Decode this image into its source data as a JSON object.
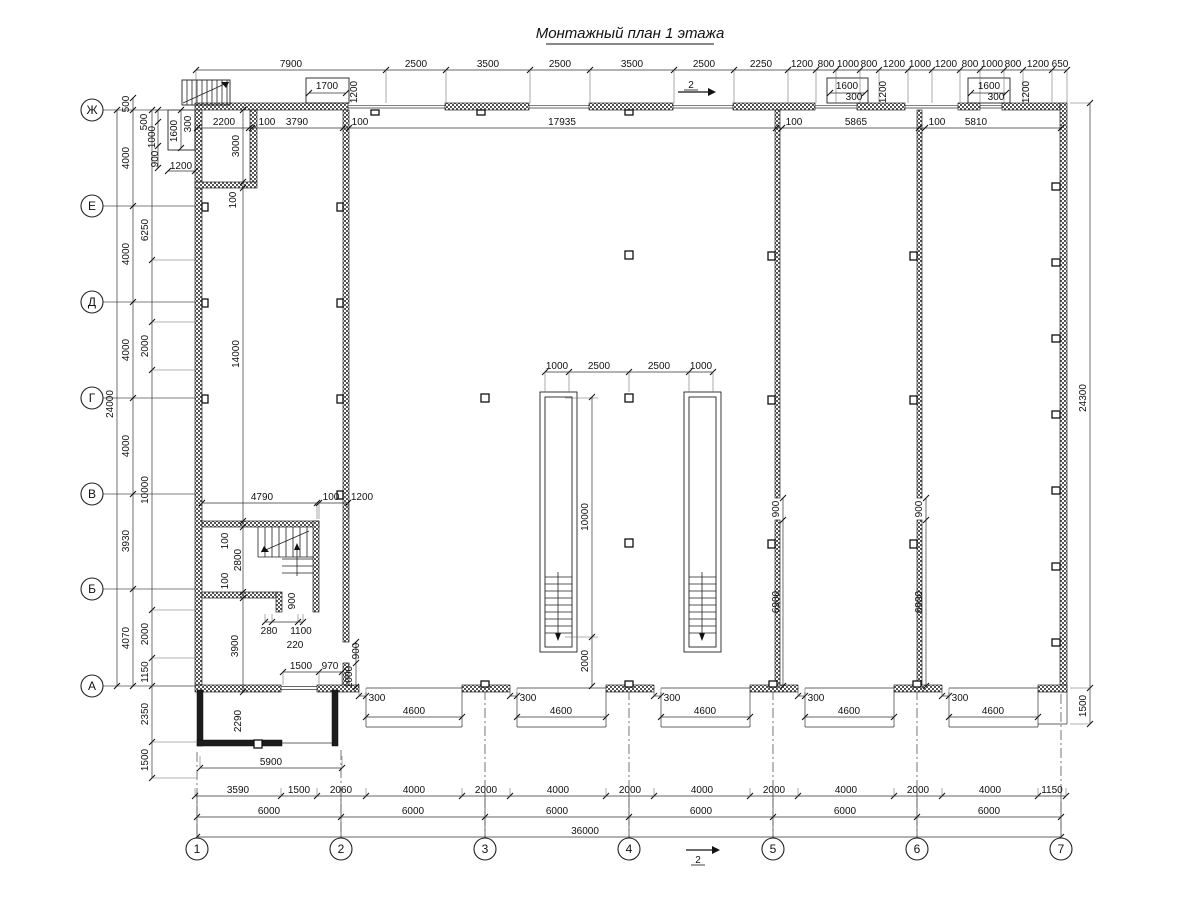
{
  "title": "Монтажный план 1 этажа",
  "axis_labels_left": [
    {
      "label": "Ж",
      "y": 110
    },
    {
      "label": "Е",
      "y": 206
    },
    {
      "label": "Д",
      "y": 302
    },
    {
      "label": "Г",
      "y": 398
    },
    {
      "label": "В",
      "y": 494
    },
    {
      "label": "Б",
      "y": 589
    },
    {
      "label": "А",
      "y": 686
    }
  ],
  "axis_labels_bottom": [
    {
      "label": "1",
      "x": 197
    },
    {
      "label": "2",
      "x": 341
    },
    {
      "label": "3",
      "x": 485
    },
    {
      "label": "4",
      "x": 629
    },
    {
      "label": "5",
      "x": 773
    },
    {
      "label": "6",
      "x": 917
    },
    {
      "label": "7",
      "x": 1061
    }
  ],
  "section_marks": [
    {
      "label": "2",
      "x1": 678,
      "y1": 92,
      "x2": 708,
      "y2": 92,
      "lx": 691,
      "ly": 88
    },
    {
      "label": "2",
      "x1": 686,
      "y1": 850,
      "x2": 712,
      "y2": 850,
      "lx": 698,
      "ly": 863
    }
  ],
  "dim_chains": [
    {
      "o": "h",
      "c": 70,
      "e": 33,
      "t": [
        196,
        386,
        446,
        530,
        590,
        674,
        734,
        788,
        816,
        836,
        860,
        879,
        908,
        932,
        960,
        980,
        1004,
        1023,
        1052,
        1067
      ],
      "l": [
        {
          "v": "7900",
          "p": 291
        },
        {
          "v": "2500",
          "p": 416
        },
        {
          "v": "3500",
          "p": 488
        },
        {
          "v": "2500",
          "p": 560
        },
        {
          "v": "3500",
          "p": 632
        },
        {
          "v": "2500",
          "p": 704
        },
        {
          "v": "2250",
          "p": 761
        },
        {
          "v": "1200",
          "p": 802
        },
        {
          "v": "800",
          "p": 826
        },
        {
          "v": "1000",
          "p": 848
        },
        {
          "v": "800",
          "p": 869
        },
        {
          "v": "1200",
          "p": 894
        },
        {
          "v": "1000",
          "p": 920
        },
        {
          "v": "1200",
          "p": 946
        },
        {
          "v": "800",
          "p": 970
        },
        {
          "v": "1000",
          "p": 992
        },
        {
          "v": "800",
          "p": 1013
        },
        {
          "v": "1200",
          "p": 1038
        },
        {
          "v": "650",
          "p": 1060
        }
      ]
    },
    {
      "o": "h",
      "c": 128,
      "t": [
        197,
        249,
        252,
        343,
        349,
        776,
        782,
        919,
        925,
        1061
      ],
      "l": [
        {
          "v": "2200",
          "p": 224
        },
        {
          "v": "100",
          "p": 267
        },
        {
          "v": "3790",
          "p": 297
        },
        {
          "v": "100",
          "p": 360
        },
        {
          "v": "17935",
          "p": 562
        },
        {
          "v": "100",
          "p": 794
        },
        {
          "v": "5865",
          "p": 856
        },
        {
          "v": "100",
          "p": 937
        },
        {
          "v": "5810",
          "p": 976
        }
      ]
    },
    {
      "o": "h",
      "c": 372,
      "e": 20,
      "t": [
        545,
        569,
        629,
        689,
        713
      ],
      "l": [
        {
          "v": "1000",
          "p": 557
        },
        {
          "v": "2500",
          "p": 599
        },
        {
          "v": "2500",
          "p": 659
        },
        {
          "v": "1000",
          "p": 701
        }
      ]
    },
    {
      "o": "h",
      "c": 503,
      "e": 16,
      "t": [
        202,
        317,
        319,
        348
      ],
      "l": [
        {
          "v": "4790",
          "p": 262
        },
        {
          "v": "100",
          "p": 331
        },
        {
          "v": "1200",
          "p": 362
        }
      ]
    },
    {
      "o": "h",
      "c": 622,
      "e": -8,
      "t": [
        265,
        272,
        298,
        303
      ],
      "l": []
    },
    {
      "o": "h",
      "c": 672,
      "e": 13,
      "t": [
        283,
        319,
        342
      ],
      "l": [
        {
          "v": "1500",
          "p": 301
        },
        {
          "v": "970",
          "p": 330
        }
      ]
    },
    {
      "o": "h",
      "c": 717,
      "t": [
        366,
        462
      ],
      "l": [
        {
          "v": "4600",
          "p": 414
        }
      ]
    },
    {
      "o": "h",
      "c": 717,
      "t": [
        517,
        606
      ],
      "l": [
        {
          "v": "4600",
          "p": 561
        }
      ]
    },
    {
      "o": "h",
      "c": 717,
      "t": [
        661,
        750
      ],
      "l": [
        {
          "v": "4600",
          "p": 705
        }
      ]
    },
    {
      "o": "h",
      "c": 717,
      "t": [
        805,
        894
      ],
      "l": [
        {
          "v": "4600",
          "p": 849
        }
      ]
    },
    {
      "o": "h",
      "c": 717,
      "t": [
        949,
        1038
      ],
      "l": [
        {
          "v": "4600",
          "p": 993
        }
      ]
    },
    {
      "o": "h",
      "c": 696,
      "e": -8,
      "t": [
        359,
        366
      ],
      "l": []
    },
    {
      "o": "h",
      "c": 696,
      "e": -8,
      "t": [
        510,
        517
      ],
      "l": []
    },
    {
      "o": "h",
      "c": 696,
      "e": -8,
      "t": [
        654,
        661
      ],
      "l": []
    },
    {
      "o": "h",
      "c": 696,
      "e": -8,
      "t": [
        798,
        805
      ],
      "l": []
    },
    {
      "o": "h",
      "c": 696,
      "e": -8,
      "t": [
        942,
        949
      ],
      "l": []
    },
    {
      "o": "h",
      "c": 796,
      "e": -8,
      "t": [
        195,
        281,
        317,
        366,
        462,
        510,
        606,
        654,
        750,
        798,
        894,
        942,
        1038,
        1066
      ],
      "l": [
        {
          "v": "3590",
          "p": 238
        },
        {
          "v": "1500",
          "p": 299
        },
        {
          "v": "2060",
          "p": 341
        },
        {
          "v": "4000",
          "p": 414
        },
        {
          "v": "2000",
          "p": 486
        },
        {
          "v": "4000",
          "p": 558
        },
        {
          "v": "2000",
          "p": 630
        },
        {
          "v": "4000",
          "p": 702
        },
        {
          "v": "2000",
          "p": 774
        },
        {
          "v": "4000",
          "p": 846
        },
        {
          "v": "2000",
          "p": 918
        },
        {
          "v": "4000",
          "p": 990
        },
        {
          "v": "1150",
          "p": 1052
        }
      ]
    },
    {
      "o": "h",
      "c": 817,
      "e": -8,
      "t": [
        197,
        341,
        485,
        629,
        773,
        917,
        1061
      ],
      "l": [
        {
          "v": "6000",
          "p": 269
        },
        {
          "v": "6000",
          "p": 413
        },
        {
          "v": "6000",
          "p": 557
        },
        {
          "v": "6000",
          "p": 701
        },
        {
          "v": "6000",
          "p": 845
        },
        {
          "v": "6000",
          "p": 989
        }
      ]
    },
    {
      "o": "h",
      "c": 837,
      "e": -8,
      "t": [
        197,
        1061
      ],
      "l": [
        {
          "v": "36000",
          "p": 585
        }
      ]
    },
    {
      "o": "v",
      "c": 117,
      "t": [
        110,
        686
      ],
      "l": [
        {
          "v": "24000",
          "p": 404
        }
      ]
    },
    {
      "o": "v",
      "c": 133,
      "t": [
        98,
        110,
        206,
        302,
        398,
        494,
        589,
        686
      ],
      "l": [
        {
          "v": "500",
          "p": 104
        },
        {
          "v": "4000",
          "p": 158
        },
        {
          "v": "4000",
          "p": 254
        },
        {
          "v": "4000",
          "p": 350
        },
        {
          "v": "4000",
          "p": 446
        },
        {
          "v": "3930",
          "p": 541
        },
        {
          "v": "4070",
          "p": 638
        }
      ]
    },
    {
      "o": "v",
      "c": 152,
      "e": 44,
      "t": [
        110,
        260,
        322,
        370,
        610,
        658,
        686,
        742,
        778
      ],
      "l": [
        {
          "v": "6250",
          "p": 230
        },
        {
          "v": "2000",
          "p": 346
        },
        {
          "v": "10000",
          "p": 490
        },
        {
          "v": "2000",
          "p": 634
        },
        {
          "v": "1150",
          "p": 672
        },
        {
          "v": "2350",
          "p": 714
        },
        {
          "v": "1500",
          "p": 760
        }
      ]
    },
    {
      "o": "v",
      "c": 158,
      "t": [
        110,
        122,
        146,
        168
      ],
      "l": []
    },
    {
      "o": "v",
      "c": 181,
      "t": [
        110,
        148
      ],
      "l": []
    },
    {
      "o": "h",
      "c": 171,
      "t": [
        168,
        195
      ],
      "l": []
    },
    {
      "o": "v",
      "c": 243,
      "t": [
        110,
        182,
        188,
        521,
        527,
        592,
        598,
        692
      ],
      "l": [
        {
          "v": "3000",
          "p": 146
        },
        {
          "v": "14000",
          "p": 354
        }
      ]
    },
    {
      "o": "v",
      "c": 592,
      "t": [
        397,
        637,
        686
      ],
      "l": [
        {
          "v": "10000",
          "p": 517
        },
        {
          "v": "2000",
          "p": 661
        }
      ]
    },
    {
      "o": "v",
      "c": 783,
      "t": [
        498,
        520,
        686
      ],
      "l": [
        {
          "v": "900",
          "p": 509
        },
        {
          "v": "6900",
          "p": 602
        }
      ]
    },
    {
      "o": "v",
      "c": 926,
      "t": [
        498,
        520,
        686
      ],
      "l": [
        {
          "v": "900",
          "p": 509
        },
        {
          "v": "6900",
          "p": 602
        }
      ]
    },
    {
      "o": "v",
      "c": 1090,
      "e": -20,
      "t": [
        103,
        688,
        724
      ],
      "l": [
        {
          "v": "24300",
          "p": 398
        },
        {
          "v": "1500",
          "p": 706
        }
      ]
    },
    {
      "o": "h",
      "c": 768,
      "e": -12,
      "t": [
        200,
        342
      ],
      "l": [
        {
          "v": "5900",
          "p": 271
        }
      ]
    },
    {
      "o": "v",
      "c": 356,
      "t": [
        642,
        663,
        687
      ],
      "l": []
    },
    {
      "o": "h",
      "c": 93,
      "t": [
        309,
        346
      ],
      "l": []
    },
    {
      "o": "h",
      "c": 93,
      "t": [
        830,
        865
      ],
      "l": []
    },
    {
      "o": "h",
      "c": 93,
      "t": [
        971,
        1006
      ],
      "l": []
    }
  ],
  "labels": [
    {
      "v": "1700",
      "x": 327,
      "y": 89
    },
    {
      "v": "1200",
      "x": 357,
      "y": 92,
      "r": -90
    },
    {
      "v": "1600",
      "x": 847,
      "y": 89
    },
    {
      "v": "300",
      "x": 854,
      "y": 100
    },
    {
      "v": "1200",
      "x": 886,
      "y": 92,
      "r": -90
    },
    {
      "v": "1600",
      "x": 989,
      "y": 89
    },
    {
      "v": "300",
      "x": 996,
      "y": 100
    },
    {
      "v": "1200",
      "x": 1029,
      "y": 92,
      "r": -90
    },
    {
      "v": "500",
      "x": 147,
      "y": 122,
      "r": -90
    },
    {
      "v": "1000",
      "x": 155,
      "y": 137,
      "r": -90
    },
    {
      "v": "1600",
      "x": 177,
      "y": 131,
      "r": -90
    },
    {
      "v": "300",
      "x": 191,
      "y": 124,
      "r": -90
    },
    {
      "v": "900",
      "x": 158,
      "y": 159,
      "r": -90
    },
    {
      "v": "1200",
      "x": 181,
      "y": 169
    },
    {
      "v": "100",
      "x": 236,
      "y": 200,
      "r": -90
    },
    {
      "v": "100",
      "x": 228,
      "y": 541,
      "r": -90
    },
    {
      "v": "2800",
      "x": 241,
      "y": 560,
      "r": -90
    },
    {
      "v": "100",
      "x": 228,
      "y": 581,
      "r": -90
    },
    {
      "v": "3900",
      "x": 238,
      "y": 646,
      "r": -90
    },
    {
      "v": "900",
      "x": 295,
      "y": 601,
      "r": -90
    },
    {
      "v": "280",
      "x": 269,
      "y": 634
    },
    {
      "v": "1100",
      "x": 301,
      "y": 634
    },
    {
      "v": "220",
      "x": 295,
      "y": 648
    },
    {
      "v": "900",
      "x": 359,
      "y": 651,
      "r": -90
    },
    {
      "v": "1000",
      "x": 352,
      "y": 677,
      "r": -90
    },
    {
      "v": "2290",
      "x": 241,
      "y": 721,
      "r": -90
    },
    {
      "v": "300",
      "x": 377,
      "y": 701
    },
    {
      "v": "300",
      "x": 528,
      "y": 701
    },
    {
      "v": "300",
      "x": 672,
      "y": 701
    },
    {
      "v": "300",
      "x": 816,
      "y": 701
    },
    {
      "v": "300",
      "x": 960,
      "y": 701
    }
  ]
}
